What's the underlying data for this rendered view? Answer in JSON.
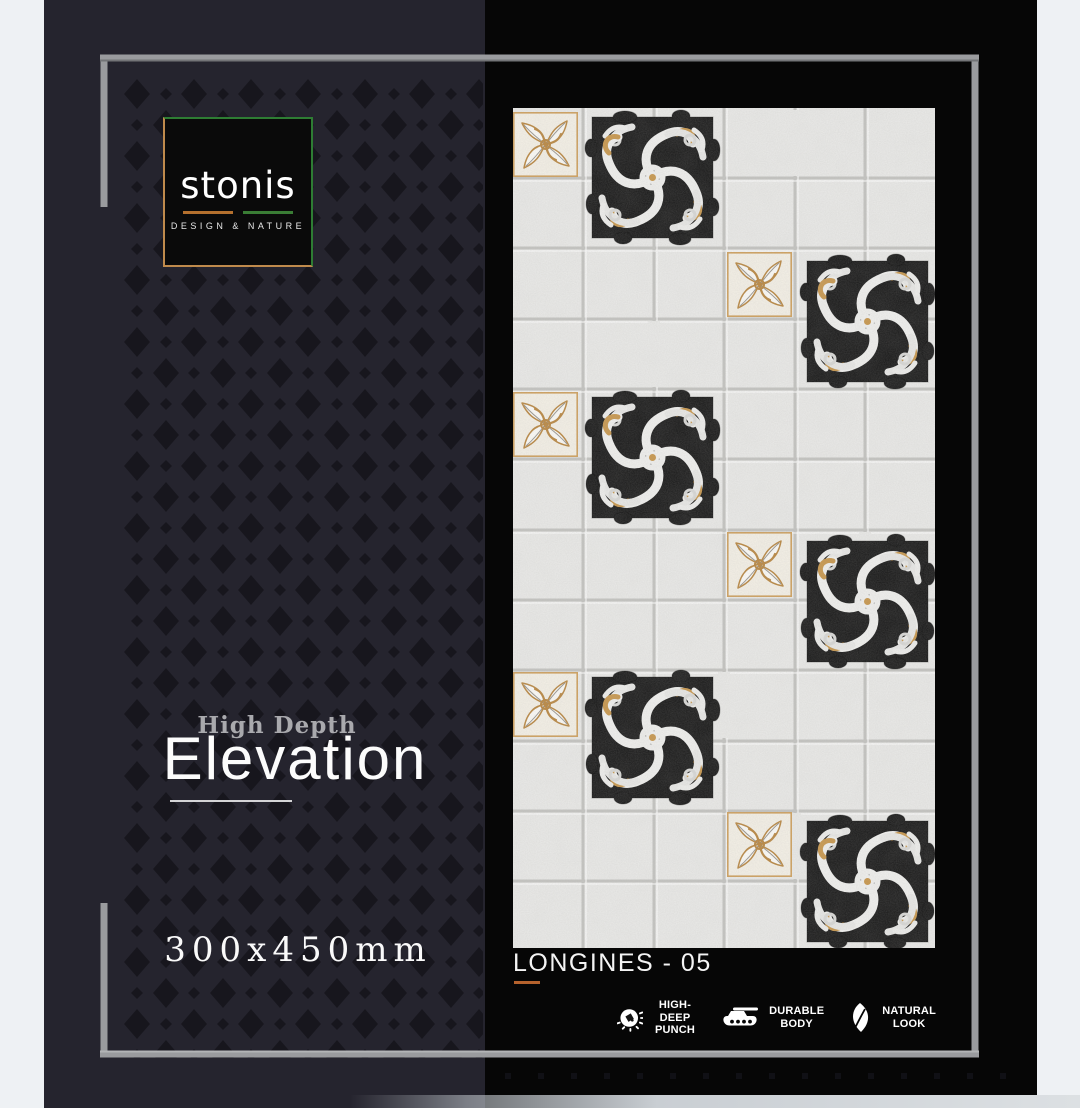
{
  "brand": {
    "name": "stonis",
    "tagline": "DESIGN & NATURE"
  },
  "series": {
    "super_title": "High Depth",
    "title": "Elevation"
  },
  "size_label": "300x450mm",
  "product": {
    "name": "LONGINES - 05"
  },
  "features": [
    {
      "icon": "punch-icon",
      "line1": "HIGH-DEEP",
      "line2": "PUNCH"
    },
    {
      "icon": "tank-icon",
      "line1": "DURABLE",
      "line2": "BODY"
    },
    {
      "icon": "leaf-icon",
      "line1": "NATURAL",
      "line2": "LOOK"
    }
  ],
  "colors": {
    "canvas_light": "#eef1f4",
    "panel_navy": "#25242e",
    "panel_black": "#060606",
    "diamond": "#17161d",
    "frame_gray": "#9a9b9e",
    "logo_green": "#2e7d33",
    "logo_gold": "#bf8a4c",
    "accent_orange": "#b5622d",
    "tile_gold": "#c8964a",
    "tile_black": "#161616",
    "tile_stone": "#ebebe9"
  }
}
